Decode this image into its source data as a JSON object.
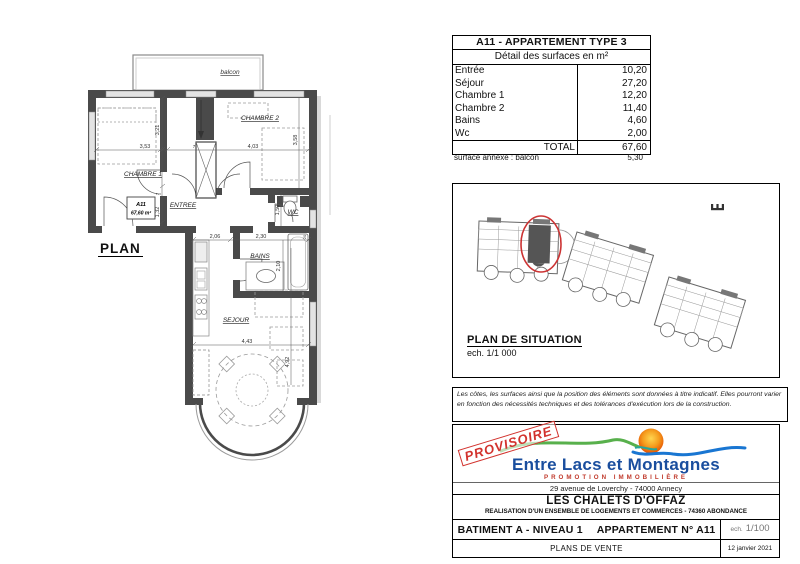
{
  "floor_plan": {
    "title": "PLAN",
    "balcony_label": "balcon",
    "unit_box": {
      "id": "A11",
      "area": "67,60 m²"
    },
    "rooms": {
      "chambre1": "CHAMBRE 1",
      "chambre2": "CHAMBRE 2",
      "entree": "ENTREE",
      "wc": "WC",
      "bains": "BAINS",
      "sejour": "SEJOUR"
    },
    "dims": {
      "chambre1_w": "3,53",
      "chambre1_d": "3,21",
      "chambre2_w": "4,03",
      "chambre2_d": "3,58",
      "partition_a": "7",
      "partition_b": "7",
      "entree_d": "1,32",
      "wc_d": "1,50",
      "kitchen_w": "2,06",
      "bains_w": "2,30",
      "bains_d": "2,10",
      "sejour_w": "4,43",
      "sejour_d": "4,92",
      "wall_t": "20"
    }
  },
  "surface_table": {
    "title": "A11 - APPARTEMENT TYPE 3",
    "subtitle": "Détail des surfaces en m²",
    "rows": [
      {
        "label": "Entrée",
        "value": "10,20"
      },
      {
        "label": "Séjour",
        "value": "27,20"
      },
      {
        "label": "Chambre 1",
        "value": "12,20"
      },
      {
        "label": "Chambre 2",
        "value": "11,40"
      },
      {
        "label": "Bains",
        "value": "4,60"
      },
      {
        "label": "Wc",
        "value": "2,00"
      }
    ],
    "total_label": "TOTAL",
    "total_value": "67,60",
    "annex_label": "surface annexe : balcon",
    "annex_value": "5,30"
  },
  "situation": {
    "title": "PLAN DE SITUATION",
    "scale": "ech. 1/1 000"
  },
  "disclaimer": "Les côtes, les surfaces ainsi que la position des éléments sont données à titre indicatif. Elles pourront varier en fonction des nécessités techniques et des tolérances d'exécution lors de la construction.",
  "footer": {
    "stamp": "PROVISOIRE",
    "brand": "Entre Lacs et Montagnes",
    "brand_tagline": "PROMOTION IMMOBILIÈRE",
    "address": "29 avenue de Loverchy - 74000 Annecy",
    "project": "LES CHALETS D'OFFAZ",
    "project_detail": "REALISATION D'UN ENSEMBLE DE LOGEMENTS ET COMMERCES - 74360 ABONDANCE",
    "unit_building": "BATIMENT A - NIVEAU 1",
    "unit_apartment": "APPARTEMENT N° A11",
    "scale_prefix": "ech.",
    "scale_value": "1/100",
    "doc_type": "PLANS DE VENTE",
    "date": "12 janvier 2021"
  },
  "colors": {
    "wall": "#4a4a4a",
    "brand_blue": "#1a4e9e",
    "brand_red": "#c0392b",
    "brand_green": "#58b04c",
    "sun_orange": "#f57c00",
    "highlight_red": "#cc3333"
  }
}
